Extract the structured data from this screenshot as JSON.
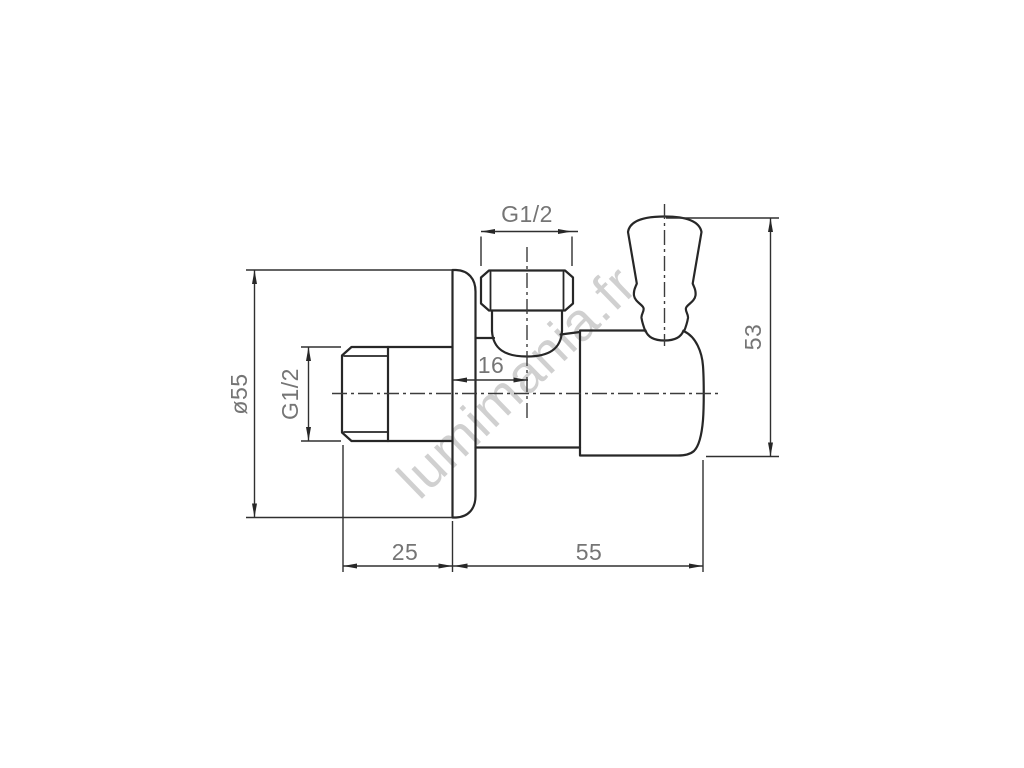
{
  "watermark": {
    "text": "lumimania.fr"
  },
  "colors": {
    "background": "#ffffff",
    "object_line": "#272727",
    "dimension_line": "#303030",
    "dimension_text": "#757575",
    "watermark_text": "#c8c8c8"
  },
  "dimensions": {
    "flange_diameter": "ø55",
    "inlet_thread_size": "G1/2",
    "outlet_thread_size": "G1/2",
    "wall_to_outlet_axis": "16",
    "overall_height": "53",
    "inlet_length": "25",
    "body_length": "55"
  }
}
